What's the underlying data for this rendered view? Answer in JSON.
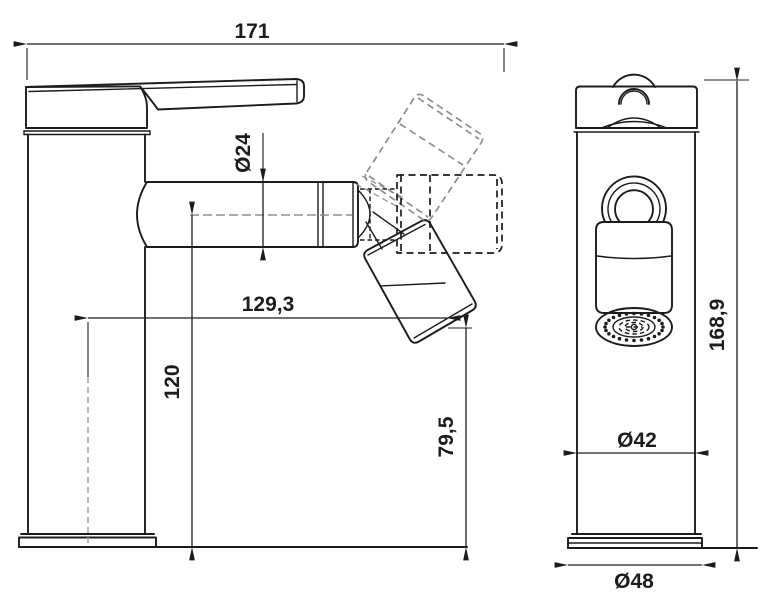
{
  "drawing": {
    "dimensions": {
      "overall_length": "171",
      "spout_diameter": "Ø24",
      "spout_reach": "129,3",
      "spout_axis_height": "120",
      "aerator_clearance_height": "79,5",
      "overall_height": "168,9",
      "body_diameter": "Ø42",
      "base_diameter": "Ø48"
    },
    "colors": {
      "line": "#1c1c1c",
      "ghost_line": "#8f8f8f",
      "background": "#ffffff"
    }
  }
}
